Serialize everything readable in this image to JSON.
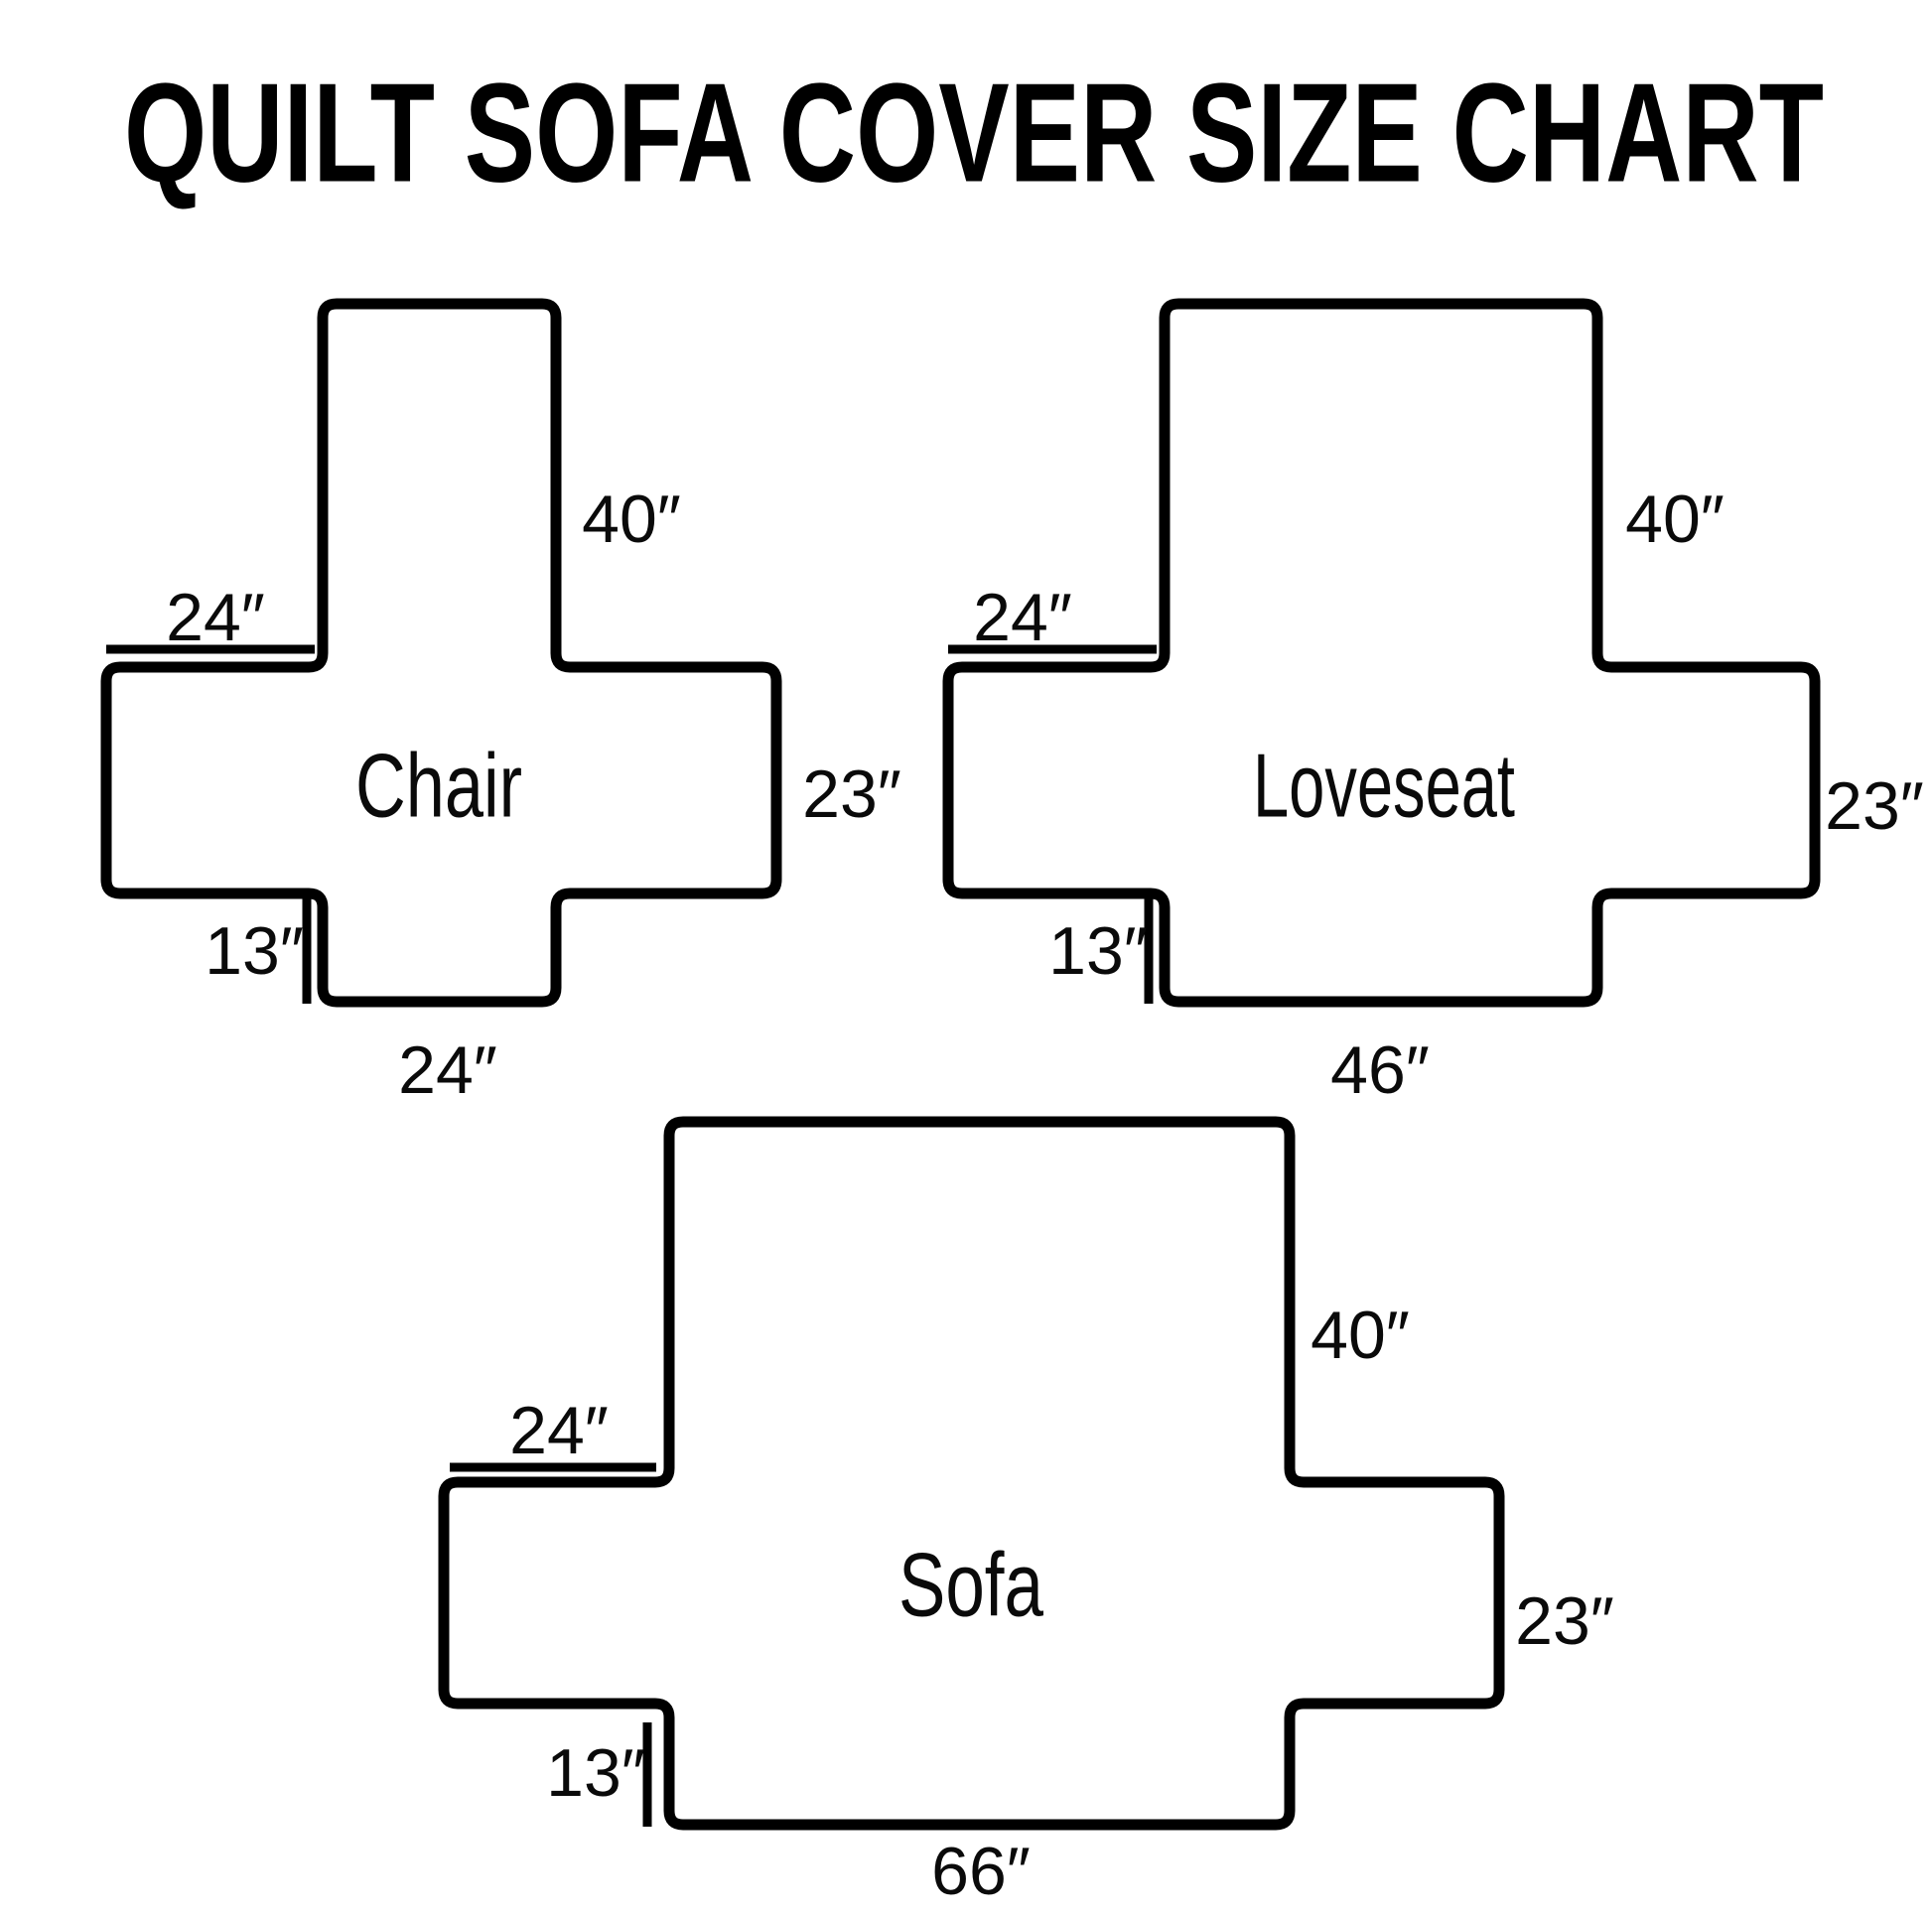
{
  "title": "QUILT SOFA COVER SIZE CHART",
  "colors": {
    "ink": "#000000",
    "background": "#ffffff"
  },
  "figures": [
    {
      "name": "Chair",
      "back_height": "40″",
      "top_width": "24″",
      "seat_depth": "23″",
      "flap_height": "13″",
      "bottom_width": "24″"
    },
    {
      "name": "Loveseat",
      "back_height": "40″",
      "top_width": "24″",
      "seat_depth": "23″",
      "flap_height": "13″",
      "bottom_width": "46″"
    },
    {
      "name": "Sofa",
      "back_height": "40″",
      "top_width": "24″",
      "seat_depth": "23″",
      "flap_height": "13″",
      "bottom_width": "66″"
    }
  ]
}
